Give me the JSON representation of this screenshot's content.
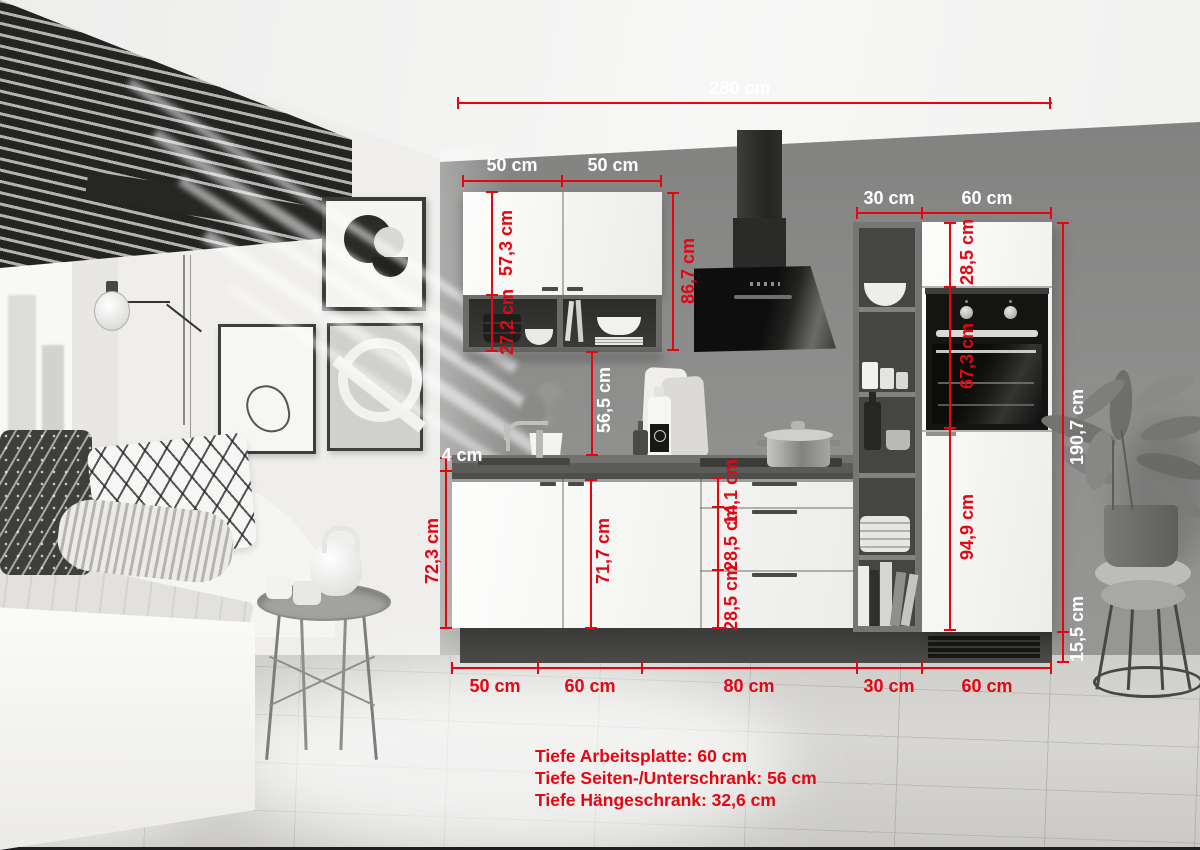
{
  "title": "Kitchen unit dimension diagram",
  "colors": {
    "annotation_red": "#e30613",
    "label_white": "#ffffff"
  },
  "measurements": {
    "total_width": "280 cm",
    "wall_cabinet_left_width": "50 cm",
    "wall_cabinet_right_width": "50 cm",
    "shelf_unit_width_top": "30 cm",
    "tall_cabinet_width_top": "60 cm",
    "wall_cabinet_door_height": "57,3 cm",
    "open_shelf_height": "27,2 cm",
    "wall_cabinet_total_height": "86,7 cm",
    "niche_height": "56,5 cm",
    "worktop_thickness": "4 cm",
    "base_cabinet_height": "72,3 cm",
    "base_door_height": "71,7 cm",
    "drawer_top_height": "14,1 cm",
    "drawer_middle_height": "28,5 cm",
    "drawer_bottom_height": "28,5 cm",
    "tall_top_door_height": "28,5 cm",
    "oven_niche_height": "67,3 cm",
    "tall_bottom_door_height": "94,9 cm",
    "tall_unit_total_height": "190,7 cm",
    "plinth_height": "15,5 cm",
    "base_width_1": "50 cm",
    "base_width_2": "60 cm",
    "base_width_3": "80 cm",
    "base_width_4": "30 cm",
    "base_width_5": "60 cm"
  },
  "notes": {
    "line1": "Tiefe Arbeitsplatte: 60 cm",
    "line2": "Tiefe Seiten-/Unterschrank: 56 cm",
    "line3": "Tiefe Hängeschrank: 32,6 cm"
  }
}
